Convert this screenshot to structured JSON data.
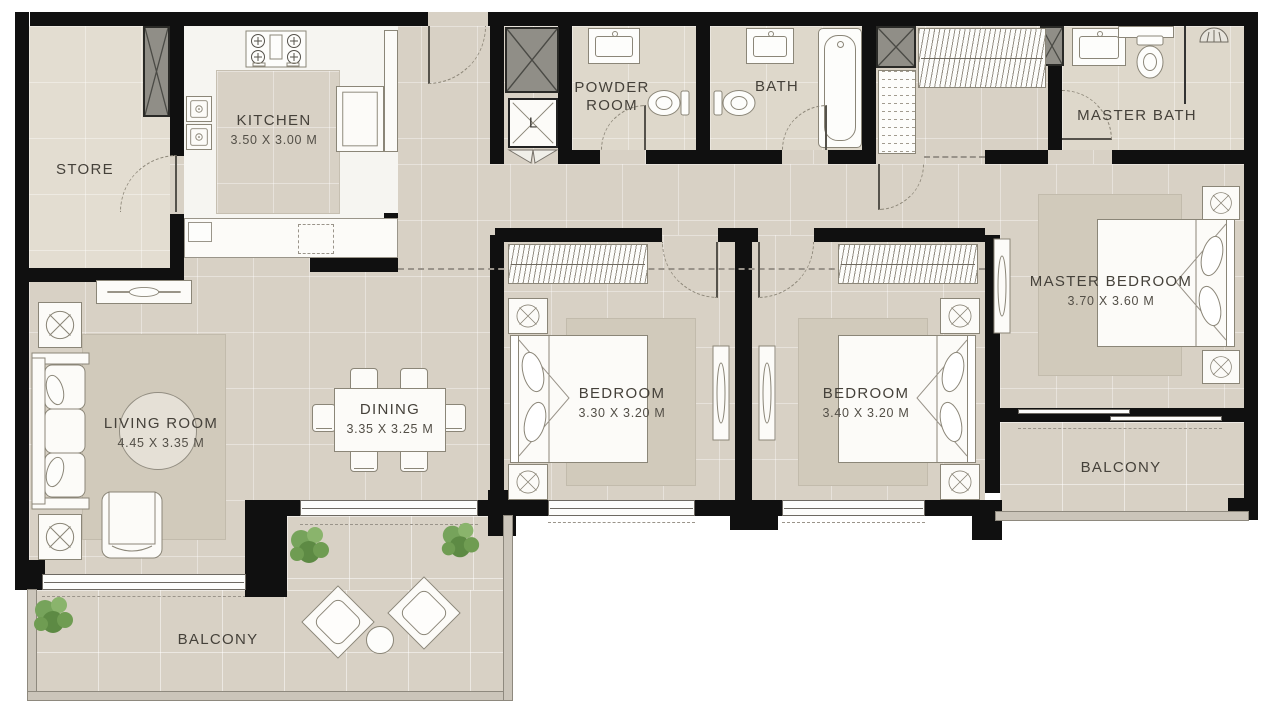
{
  "plan": {
    "rooms": {
      "store": {
        "label": "STORE"
      },
      "kitchen": {
        "label": "KITCHEN",
        "dims": "3.50 X 3.00 M"
      },
      "powder_room": {
        "label": "POWDER ROOM"
      },
      "bath": {
        "label": "BATH"
      },
      "master_bath": {
        "label": "MASTER BATH"
      },
      "living_room": {
        "label": "LIVING ROOM",
        "dims": "4.45 X 3.35 M"
      },
      "dining": {
        "label": "DINING",
        "dims": "3.35 X 3.25 M"
      },
      "bedroom_1": {
        "label": "BEDROOM",
        "dims": "3.30 X 3.20 M"
      },
      "bedroom_2": {
        "label": "BEDROOM",
        "dims": "3.40 X 3.20 M"
      },
      "master_bedroom": {
        "label": "MASTER BEDROOM",
        "dims": "3.70 X 3.60 M"
      },
      "balcony_main": {
        "label": "BALCONY"
      },
      "balcony_master": {
        "label": "BALCONY"
      }
    },
    "markers": {
      "laundry": "L"
    },
    "colors": {
      "wall": "#101010",
      "floor": "#d8d1c5",
      "floor_light": "#e3ddd1",
      "bath_floor": "#ded8cb",
      "kitchen_floor": "#f6f5f1",
      "furniture_outline": "#8b8678",
      "plant_green": "#6f9c52",
      "label_text": "#45413a"
    }
  }
}
